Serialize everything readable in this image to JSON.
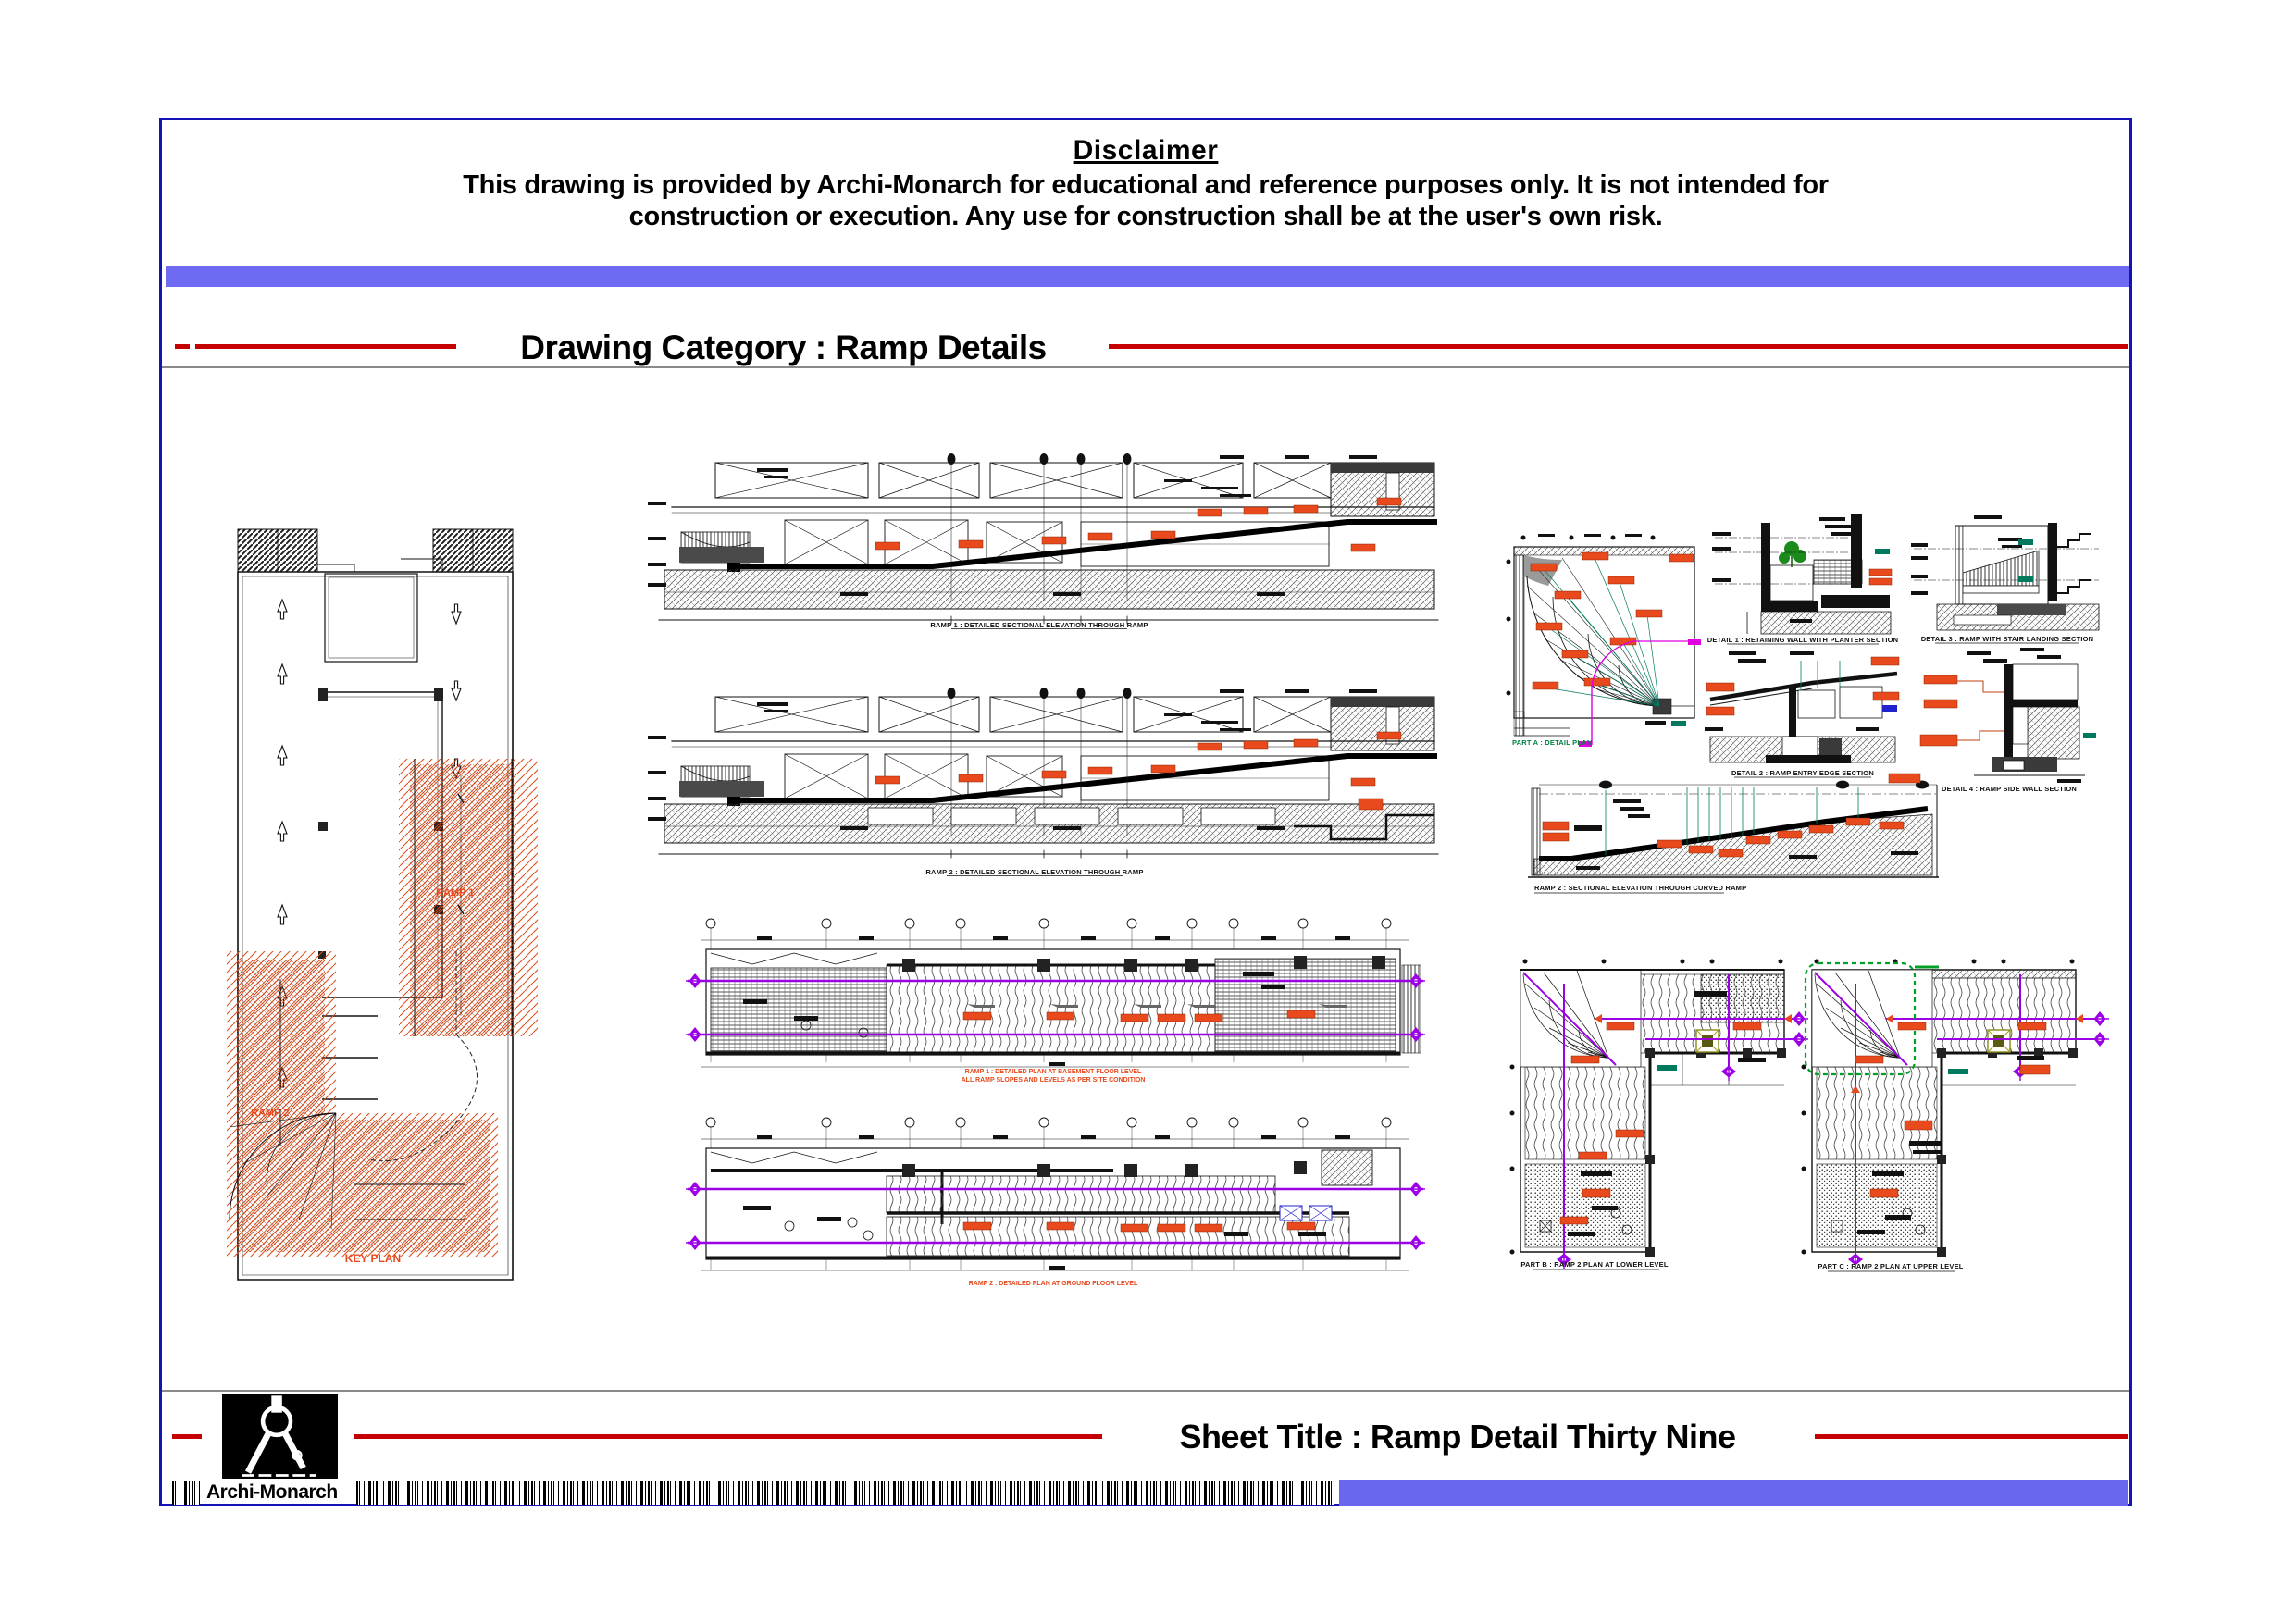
{
  "disclaimer": {
    "title": "Disclaimer",
    "line1": "This drawing is provided by Archi-Monarch for educational and reference purposes only. It is not intended for",
    "line2": "construction or execution. Any use for construction shall be at the user's own risk."
  },
  "category": {
    "label": "Drawing Category : Ramp Details"
  },
  "sheet": {
    "label": "Sheet Title : Ramp Detail Thirty Nine"
  },
  "brand": {
    "name": "Archi-Monarch"
  },
  "key_plan": {
    "ramp1": "RAMP 1",
    "ramp2": "RAMP 2",
    "caption": "KEY PLAN"
  },
  "captions": {
    "section1": "RAMP 1 : DETAILED SECTIONAL ELEVATION THROUGH RAMP",
    "section2": "RAMP 2 : DETAILED SECTIONAL ELEVATION THROUGH RAMP",
    "plan1_line1": "RAMP 1 : DETAILED PLAN AT BASEMENT FLOOR LEVEL",
    "plan1_line2": "ALL RAMP SLOPES AND LEVELS AS PER SITE CONDITION",
    "plan2": "RAMP 2 : DETAILED PLAN AT GROUND FLOOR LEVEL",
    "curve_plan": "PART A : DETAIL PLAN",
    "detail_a": "DETAIL 1 : RETAINING WALL WITH PLANTER SECTION",
    "detail_b": "DETAIL 2 : RAMP ENTRY EDGE SECTION",
    "detail_c": "DETAIL 3 : RAMP WITH STAIR LANDING SECTION",
    "detail_d": "DETAIL 4 : RAMP SIDE WALL SECTION",
    "long_section": "RAMP 2 : SECTIONAL ELEVATION THROUGH CURVED RAMP",
    "lplan1": "PART B : RAMP 2 PLAN AT LOWER LEVEL",
    "lplan2": "PART C : RAMP 2 PLAN AT UPPER LEVEL"
  },
  "colors": {
    "border_blue": "#1414b4",
    "band_blue": "#6f6af2",
    "line_red": "#c40000",
    "cad_orange": "#e8491d",
    "cad_magenta": "#9c00e6",
    "cad_green": "#007a5e",
    "highlight_green": "#00a028",
    "caption_green": "#008040"
  }
}
